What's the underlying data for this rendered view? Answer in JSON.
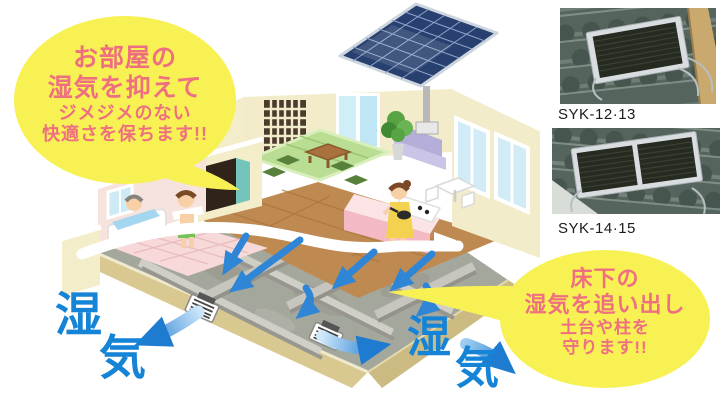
{
  "palette": {
    "bubble_yellow": "#f8f154",
    "callout_text_pink": "#ee7080",
    "moisture_blue": "#1583d6",
    "arrow_blue": "#2f85d6",
    "product_label_black": "#1b1b1b"
  },
  "callouts": {
    "room": {
      "line1": "お部屋の",
      "line2": "湿気を抑えて",
      "line3": "ジメジメのない",
      "line4": "快適さを保ちます!!"
    },
    "underfloor": {
      "line1": "床下の",
      "line2": "湿気を追い出し",
      "line3": "土台や柱を",
      "line4": "守ります!!"
    }
  },
  "moisture_labels": {
    "left": {
      "char1": "湿",
      "char2": "気"
    },
    "right": {
      "char1": "湿",
      "char2": "気"
    }
  },
  "products": [
    {
      "model": "SYK-12·13"
    },
    {
      "model": "SYK-14·15"
    }
  ]
}
